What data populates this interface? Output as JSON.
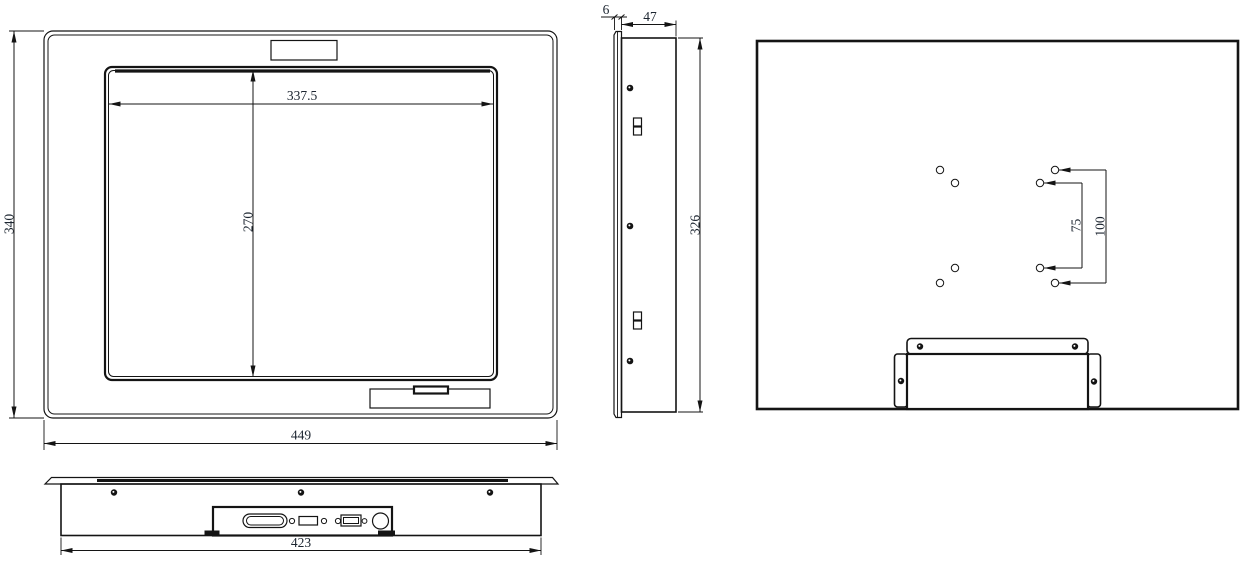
{
  "drawing": {
    "type": "engineering-dimension-drawing",
    "background_color": "#ffffff",
    "line_color": "#141414",
    "views": {
      "front": "front-view",
      "side": "side-view",
      "rear": "rear-view",
      "bottom": "bottom-view"
    }
  },
  "dimensions": {
    "front_overall_height": "340",
    "front_overall_width": "449",
    "display_area_width": "337.5",
    "display_area_height": "270",
    "side_bezel_thickness": "6",
    "side_depth": "47",
    "side_body_height": "326",
    "vesa_pitch_inner": "75",
    "vesa_pitch_outer": "100",
    "bottom_mount_width": "423"
  }
}
